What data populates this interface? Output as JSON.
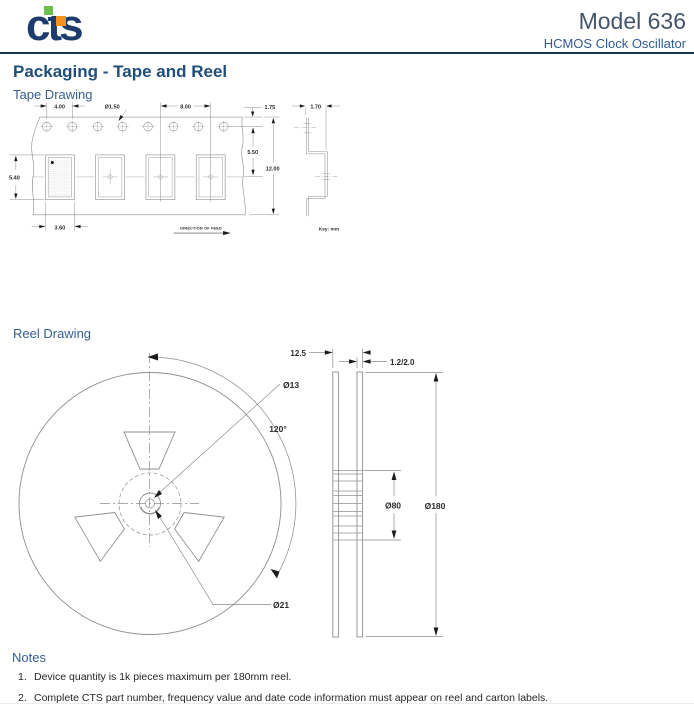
{
  "header": {
    "logo_text": "cts",
    "model": "Model 636",
    "subtitle": "HCMOS Clock Oscillator"
  },
  "section_title": "Packaging  -  Tape and Reel",
  "tape_drawing": {
    "label": "Tape Drawing",
    "dimensions": {
      "sprocket_pitch": "4.00",
      "sprocket_hole_diameter": "Ø1.50",
      "pocket_pitch": "8.00",
      "edge_to_hole_center": "1.75",
      "pocket_depth": "1.70",
      "hole_to_pocket_center": "5.50",
      "tape_width": "12.00",
      "pocket_length": "5.40",
      "pocket_width": "3.60"
    },
    "direction_of_feed": "DIRECTION OF FEED",
    "key": "Key: mm"
  },
  "reel_drawing": {
    "label": "Reel Drawing",
    "dimensions": {
      "reel_width": "12.5",
      "flange_thickness": "1.2/2.0",
      "arbor_hole_diameter": "Ø13",
      "window_angle": "120°",
      "hub_diameter": "Ø80",
      "reel_diameter": "Ø180",
      "key_slot_diameter": "Ø21"
    }
  },
  "notes": {
    "label": "Notes",
    "items": [
      {
        "num": "1.",
        "text": "Device quantity is 1k pieces maximum per 180mm reel."
      },
      {
        "num": "2.",
        "text": "Complete CTS part number, frequency value and date code information must appear on reel and carton labels."
      }
    ]
  },
  "colors": {
    "navy_rule": "#17365d",
    "heading_blue": "#1f4e79",
    "subheading_blue": "#366092",
    "logo_navy": "#1d3c6b",
    "logo_green": "#6cbf4c",
    "logo_orange": "#f6921e",
    "drawing_line_gray": "#8f8f8f",
    "dimension_text": "#2b2b2b"
  }
}
